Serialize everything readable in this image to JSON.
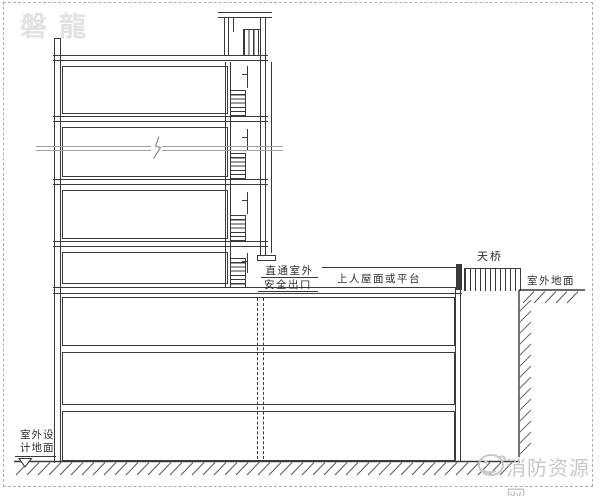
{
  "watermarks": {
    "top_left": "磐龍",
    "bottom_right": "消防资源网"
  },
  "labels": {
    "exit_line1": "直通室外",
    "exit_line2": "安全出口",
    "roof_platform": "上人屋面或平台",
    "bridge": "天桥",
    "outdoor_ground": "室外地面",
    "design_ground_line1": "室外设",
    "design_ground_line2": "计地面"
  },
  "colors": {
    "line": "#3a3a3a",
    "break_line": "#a0a0a0",
    "watermark_top": "#e2e2e2",
    "watermark_bottom": "#c8c8c8",
    "hatch": "#5a5a5a",
    "frame_dash": "#aeaeae"
  }
}
